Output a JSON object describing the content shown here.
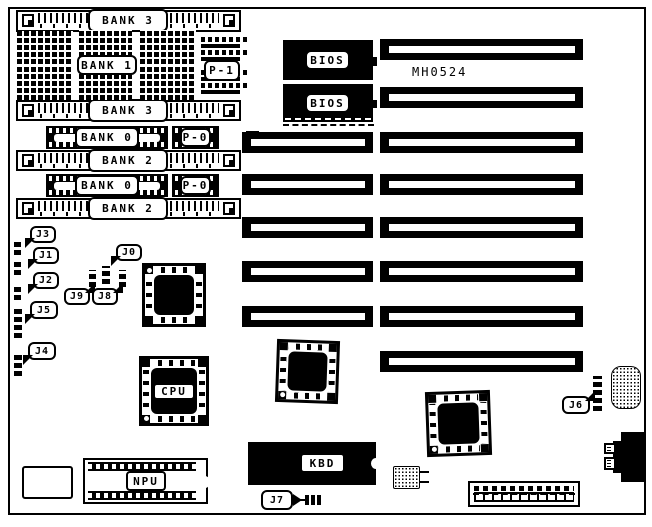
{
  "board": {
    "part_number": "MH0524"
  },
  "memory": {
    "simm_sockets": [
      {
        "label": "BANK 3"
      },
      {
        "label": "BANK 3"
      },
      {
        "label": "BANK 2"
      },
      {
        "label": "BANK 2"
      }
    ],
    "dip_bank": {
      "label": "BANK 1",
      "parity_label": "P-1"
    },
    "sipp_banks": [
      {
        "label": "BANK 0",
        "parity_label": "P-0"
      },
      {
        "label": "BANK 0",
        "parity_label": "P-0"
      }
    ]
  },
  "chips": {
    "bios": [
      {
        "label": "BIOS"
      },
      {
        "label": "BIOS"
      }
    ],
    "cpu": {
      "label": "CPU"
    },
    "npu": {
      "label": "NPU"
    },
    "keyboard_controller": {
      "label": "KBD"
    }
  },
  "jumpers": {
    "j0": {
      "label": "J0"
    },
    "j1": {
      "label": "J1"
    },
    "j2": {
      "label": "J2"
    },
    "j3": {
      "label": "J3"
    },
    "j4": {
      "label": "J4"
    },
    "j5": {
      "label": "J5"
    },
    "j6": {
      "label": "J6"
    },
    "j7": {
      "label": "J7"
    },
    "j8": {
      "label": "J8"
    },
    "j9": {
      "label": "J9"
    }
  },
  "colors": {
    "silkscreen": "#000000",
    "background": "#ffffff"
  }
}
